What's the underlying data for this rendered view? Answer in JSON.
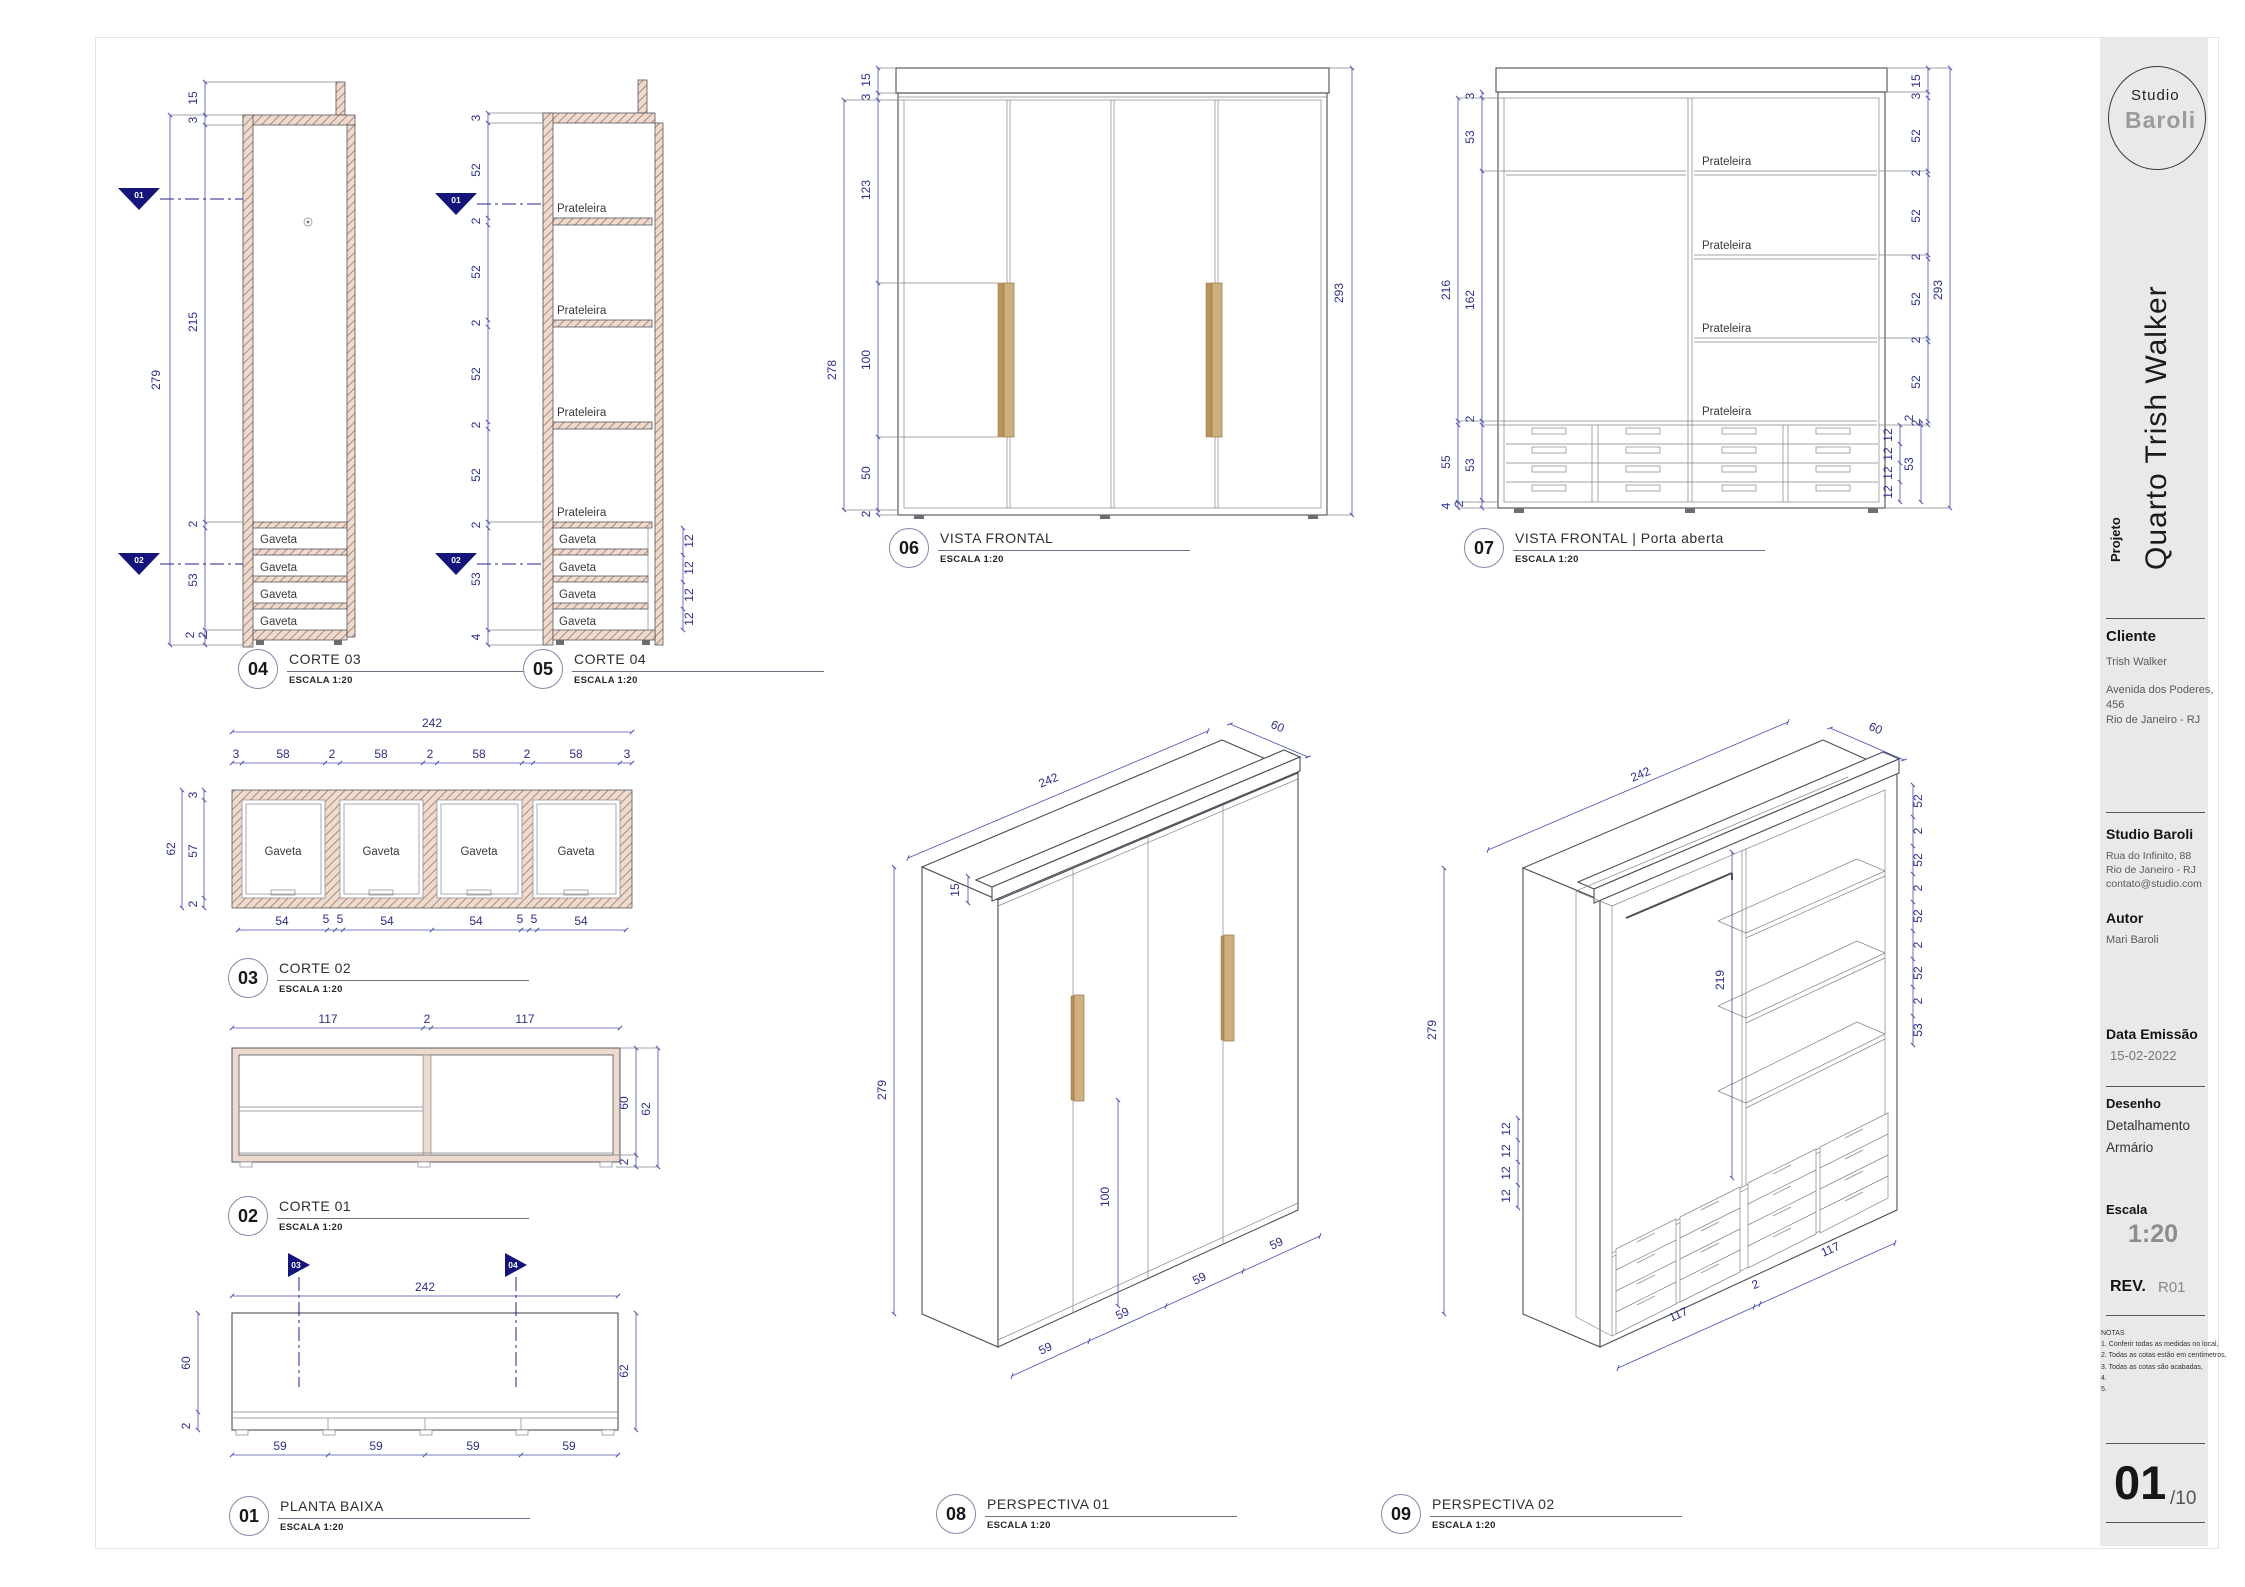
{
  "labels": {
    "escala": "ESCALA 1:20",
    "gaveta": "Gaveta",
    "prateleira": "Prateleira"
  },
  "title_block": {
    "logo_top": "Studio",
    "logo_bottom": "Baroli",
    "projeto_label": "Projeto",
    "projeto_value": "Quarto Trish Walker",
    "cliente_label": "Cliente",
    "cliente_name": "Trish Walker",
    "cliente_address": [
      "Avenida dos Poderes,",
      "456",
      "Rio de Janeiro - RJ"
    ],
    "studio_name": "Studio Baroli",
    "studio_address": [
      "Rua do Infinito, 88",
      "Rio de Janeiro - RJ",
      "contato@studio.com"
    ],
    "autor_label": "Autor",
    "autor_value": "Mari Baroli",
    "data_label": "Data Emissão",
    "data_value": "15-02-2022",
    "desenho_label": "Desenho",
    "desenho_line1": "Detalhamento",
    "desenho_line2": "Armário",
    "escala_label": "Escala",
    "escala_value": "1:20",
    "rev_label": "REV.",
    "rev_value": "R01",
    "notas_title": "NOTAS",
    "notas": [
      "1. Conferir todas as medidas no local,",
      "2. Todas as cotas estão em centímetros,",
      "3. Todas as cotas são acabadas,",
      "4.",
      "5."
    ],
    "page_number": "01",
    "page_total": "/10"
  },
  "views": {
    "v01": {
      "num": "01",
      "title": "PLANTA BAIXA",
      "markers": [
        "03",
        "04"
      ],
      "dims": {
        "w": "242",
        "depth": "60",
        "front": "2",
        "right": "62",
        "seg": [
          "59",
          "59",
          "59",
          "59"
        ]
      }
    },
    "v02": {
      "num": "02",
      "title": "CORTE 01",
      "dims": {
        "left": "117",
        "mid": "2",
        "right": "117",
        "h": "60",
        "total": "62",
        "base": "2"
      }
    },
    "v03": {
      "num": "03",
      "title": "CORTE 02",
      "dims": {
        "total": "242",
        "chain": [
          "3",
          "58",
          "2",
          "58",
          "2",
          "58",
          "2",
          "58",
          "3"
        ],
        "left": [
          "62",
          "3",
          "57",
          "2"
        ],
        "bottom": [
          "54",
          "5",
          "5",
          "54",
          "54",
          "5",
          "5",
          "54"
        ]
      }
    },
    "v04": {
      "num": "04",
      "title": "CORTE 03",
      "markers": [
        "01",
        "02"
      ],
      "dims": {
        "tab": "15",
        "top": "3",
        "body": "215",
        "total": "279",
        "sep": "2",
        "drawers": "53",
        "base1": "2",
        "base2": "2"
      }
    },
    "v05": {
      "num": "05",
      "title": "CORTE 04",
      "markers": [
        "01",
        "02"
      ],
      "dims": {
        "top": "3",
        "shelf": [
          "52",
          "52",
          "52",
          "52"
        ],
        "thick": [
          "2",
          "2",
          "2",
          "2"
        ],
        "drawers": "53",
        "base": "4",
        "dr": [
          "12",
          "12",
          "12",
          "12"
        ]
      }
    },
    "v06": {
      "num": "06",
      "title": "VISTA FRONTAL",
      "dims": {
        "crown": "15",
        "top": "3",
        "upper": "123",
        "handle": "100",
        "lower": "50",
        "base": "2",
        "doors": "278",
        "total": "293"
      }
    },
    "v07": {
      "num": "07",
      "title": "VISTA FRONTAL | Porta aberta",
      "dims": {
        "top": "3",
        "hat": "53",
        "inner": "216",
        "hang": "162",
        "sep": "2",
        "dz": "55",
        "dzi": "53",
        "b2": "2",
        "base": "4",
        "crown": "15",
        "rtop": "3",
        "shelf": [
          "52",
          "52",
          "52",
          "52"
        ],
        "thick": [
          "2",
          "2",
          "2",
          "2"
        ],
        "total": "293",
        "d2": "2",
        "dr": [
          "12",
          "12",
          "12",
          "12"
        ],
        "drz": "53"
      }
    },
    "v08": {
      "num": "08",
      "title": "PERSPECTIVA 01",
      "dims": {
        "w": "242",
        "d": "60",
        "h": "279",
        "crown": "15",
        "handle": "100",
        "seg": [
          "59",
          "59",
          "59",
          "59"
        ]
      }
    },
    "v09": {
      "num": "09",
      "title": "PERSPECTIVA 02",
      "dims": {
        "w": "242",
        "d": "60",
        "h": "279",
        "int": "219",
        "shelf": [
          "52",
          "52",
          "52",
          "52"
        ],
        "thick": [
          "2",
          "2",
          "2",
          "2"
        ],
        "dz": "53",
        "dr": [
          "12",
          "12",
          "12",
          "12"
        ],
        "bl": "117",
        "bm": "2",
        "br": "117"
      }
    }
  }
}
